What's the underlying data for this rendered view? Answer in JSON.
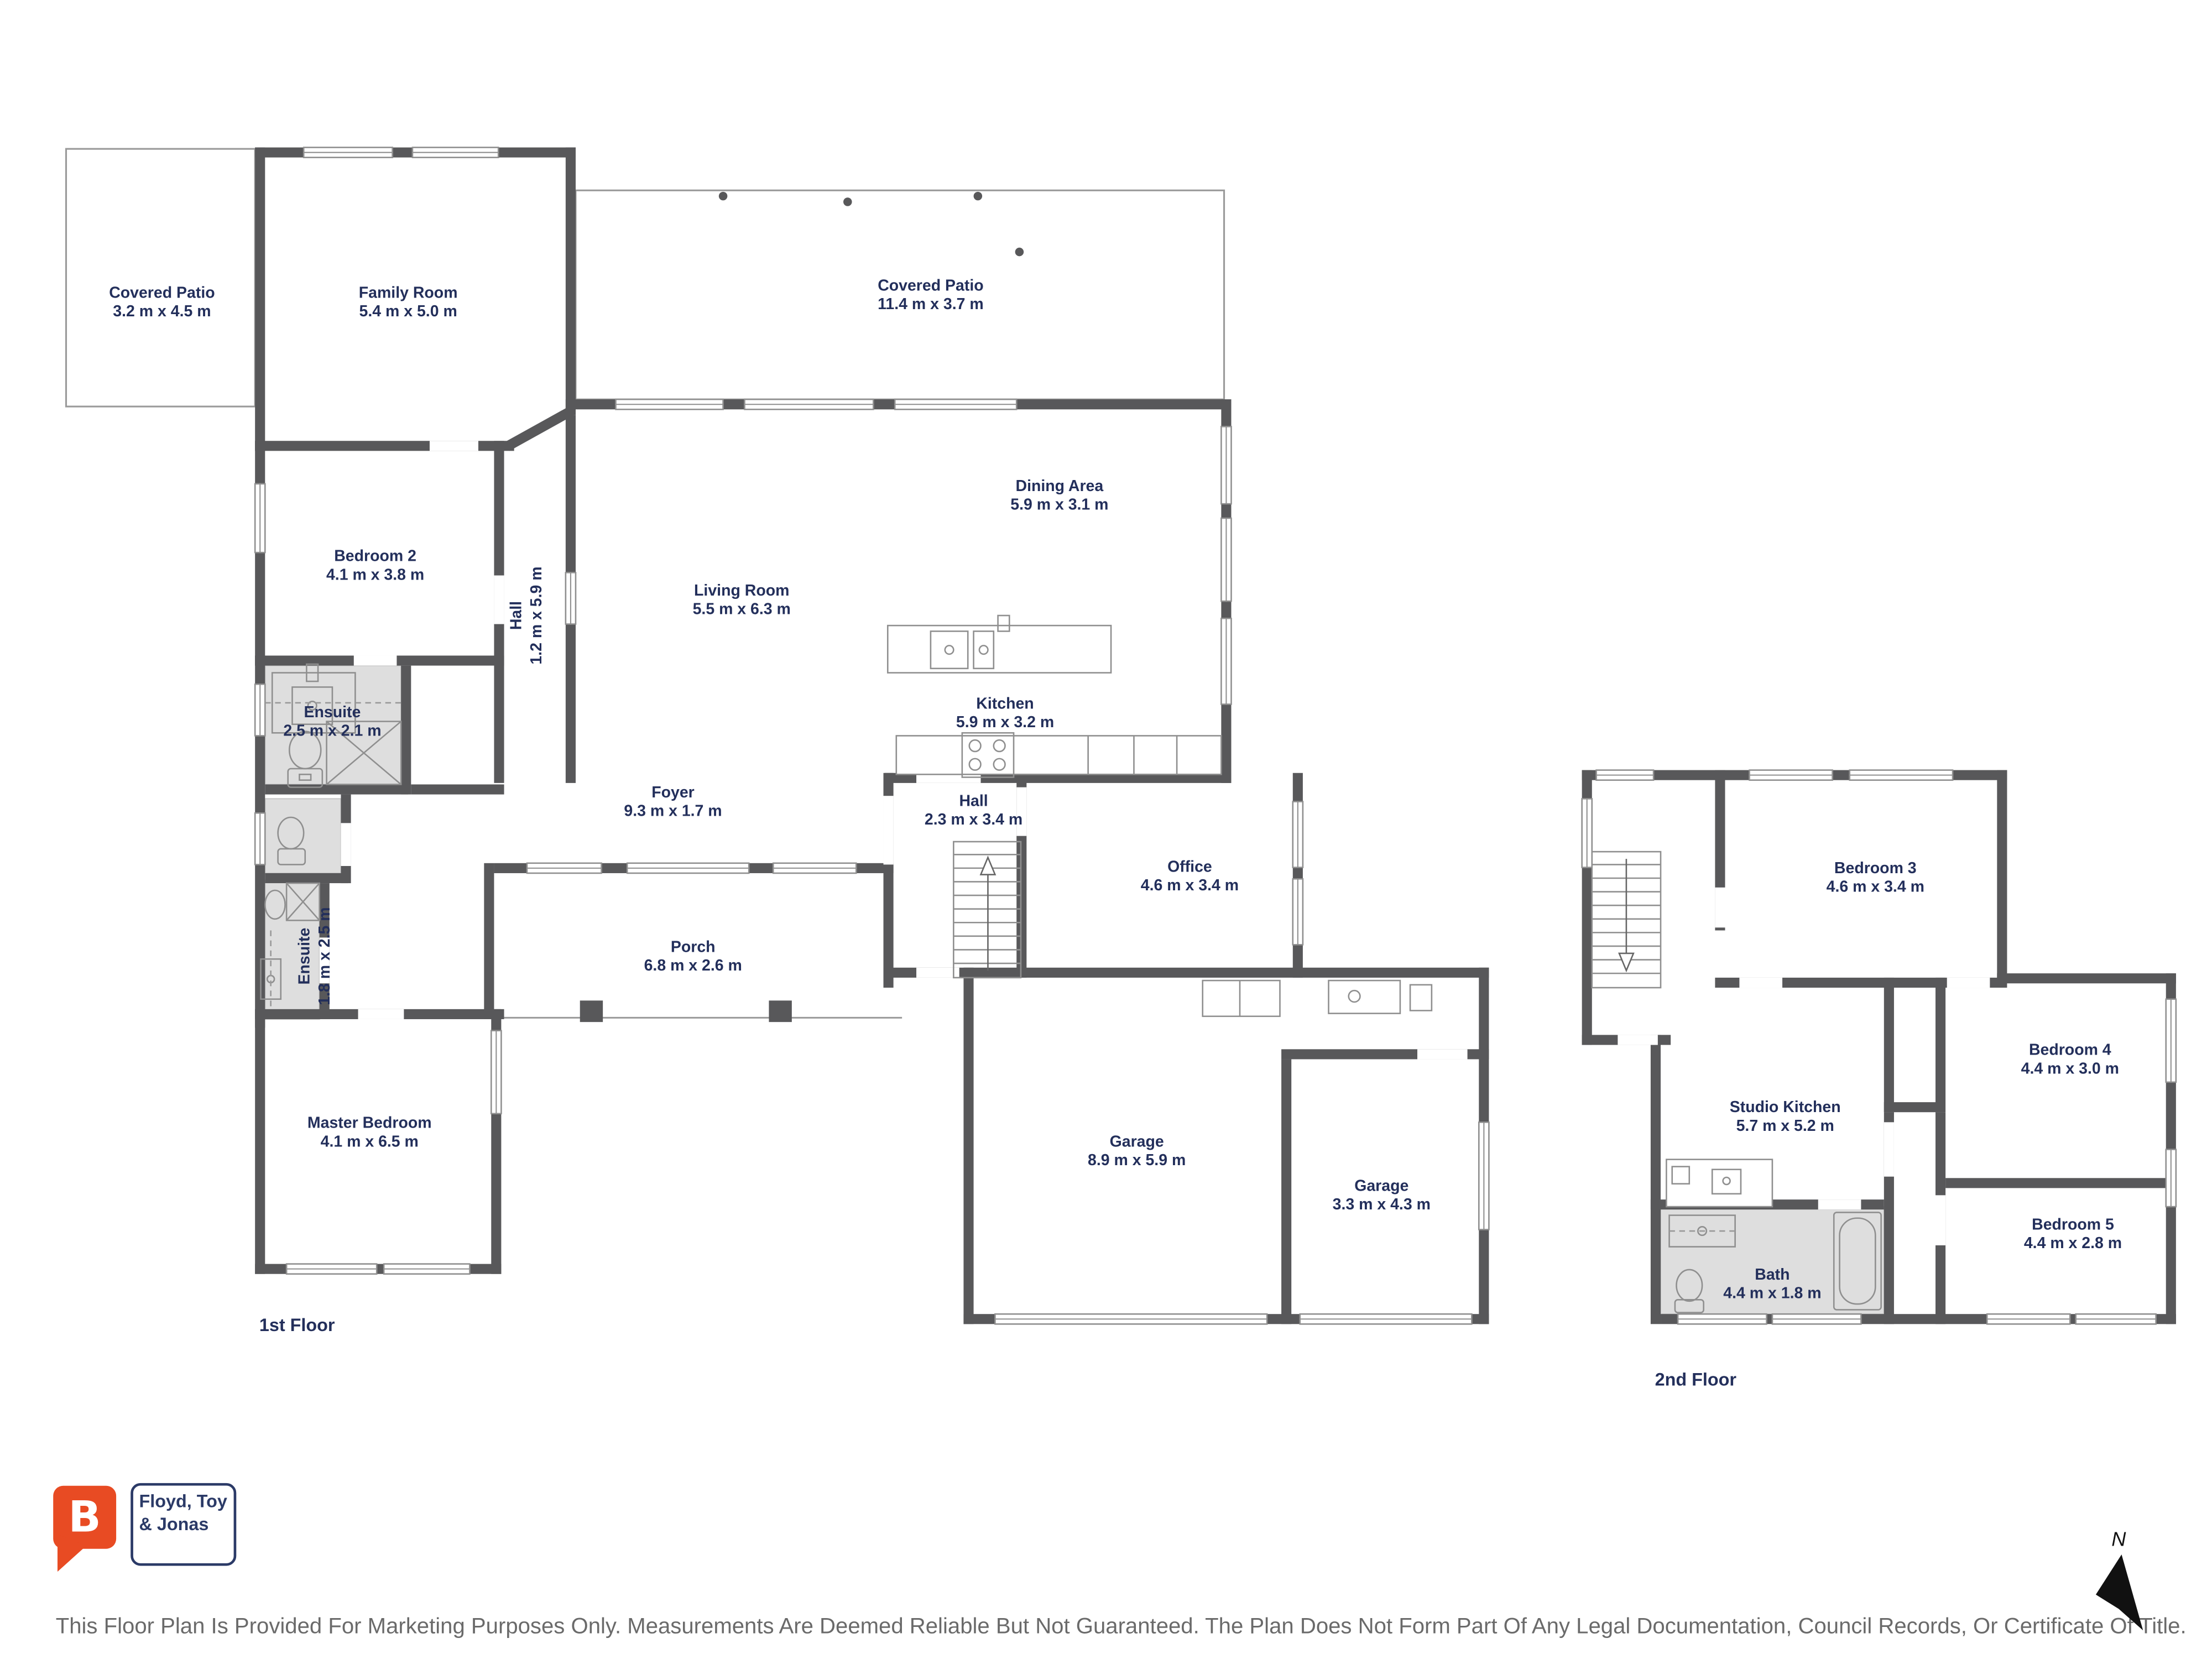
{
  "floor1": {
    "label": "1st Floor",
    "rooms": {
      "covered_patio_1": {
        "name": "Covered Patio",
        "dims": "3.2 m x 4.5 m"
      },
      "family_room": {
        "name": "Family Room",
        "dims": "5.4 m x 5.0 m"
      },
      "covered_patio_2": {
        "name": "Covered Patio",
        "dims": "11.4 m x 3.7 m"
      },
      "bedroom_2": {
        "name": "Bedroom 2",
        "dims": "4.1 m x 3.8 m"
      },
      "hall_1": {
        "name": "Hall",
        "dims": "1.2 m x 5.9 m"
      },
      "dining_area": {
        "name": "Dining Area",
        "dims": "5.9 m x 3.1 m"
      },
      "living_room": {
        "name": "Living Room",
        "dims": "5.5 m x 6.3 m"
      },
      "kitchen": {
        "name": "Kitchen",
        "dims": "5.9 m x 3.2 m"
      },
      "ensuite_1": {
        "name": "Ensuite",
        "dims": "2.5 m x 2.1 m"
      },
      "foyer": {
        "name": "Foyer",
        "dims": "9.3 m x 1.7 m"
      },
      "hall_2": {
        "name": "Hall",
        "dims": "2.3 m x 3.4 m"
      },
      "office": {
        "name": "Office",
        "dims": "4.6 m x 3.4 m"
      },
      "ensuite_2": {
        "name": "Ensuite",
        "dims": "1.8 m x 2.5 m"
      },
      "porch": {
        "name": "Porch",
        "dims": "6.8 m x 2.6 m"
      },
      "master_bedroom": {
        "name": "Master Bedroom",
        "dims": "4.1 m x 6.5 m"
      },
      "garage_1": {
        "name": "Garage",
        "dims": "8.9 m x 5.9 m"
      },
      "garage_2": {
        "name": "Garage",
        "dims": "3.3 m x 4.3 m"
      }
    }
  },
  "floor2": {
    "label": "2nd Floor",
    "rooms": {
      "bedroom_3": {
        "name": "Bedroom 3",
        "dims": "4.6 m x 3.4 m"
      },
      "studio_kitchen": {
        "name": "Studio Kitchen",
        "dims": "5.7 m x 5.2 m"
      },
      "bedroom_4": {
        "name": "Bedroom 4",
        "dims": "4.4 m x 3.0 m"
      },
      "bedroom_5": {
        "name": "Bedroom 5",
        "dims": "4.4 m x 2.8 m"
      },
      "bath": {
        "name": "Bath",
        "dims": "4.4 m x 1.8 m"
      }
    }
  },
  "branding": {
    "logo_letter": "B",
    "agency_line1": "Floyd, Toy",
    "agency_line2": "& Jonas",
    "logo_color": "#e84b23",
    "text_color": "#2b3a67"
  },
  "compass": {
    "label": "N"
  },
  "disclaimer": "This Floor Plan Is Provided For Marketing Purposes Only. Measurements Are Deemed Reliable But Not Guaranteed. The Plan Does Not Form Part Of Any Legal Documentation, Council Records, Or Certificate Of Title.",
  "colors": {
    "wall": "#58585a",
    "wet_area_fill": "#dedede",
    "label_text": "#232f5b",
    "disclaimer_text": "#6a6a6a"
  }
}
